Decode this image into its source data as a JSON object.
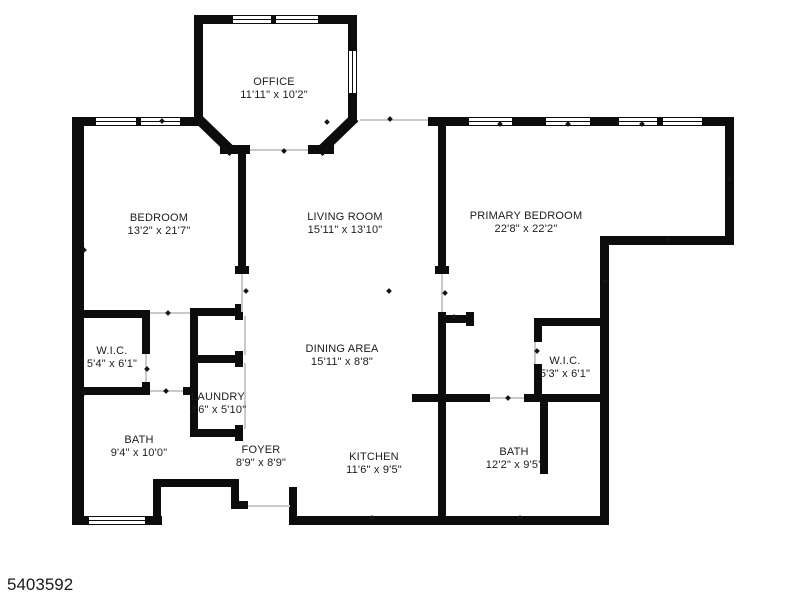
{
  "image_type": "floor-plan",
  "colors": {
    "wall": "#0c0c0c",
    "background": "#ffffff",
    "text": "#1c1c1c",
    "opening_line": "#c9c9c9"
  },
  "footer": {
    "listing_id": "5403592"
  },
  "rooms": [
    {
      "name": "OFFICE",
      "dims": "11'11\" x 10'2\""
    },
    {
      "name": "BEDROOM",
      "dims": "13'2\" x 21'7\""
    },
    {
      "name": "LIVING ROOM",
      "dims": "15'11\" x 13'10\""
    },
    {
      "name": "PRIMARY BEDROOM",
      "dims": "22'8\" x 22'2\""
    },
    {
      "name": "W.I.C.",
      "dims": "5'4\" x 6'1\""
    },
    {
      "name": "DINING AREA",
      "dims": "15'11\" x 8'8\""
    },
    {
      "name": "W.I.C.",
      "dims": "5'3\" x 6'1\""
    },
    {
      "name": "LAUNDRY",
      "dims": "3'6\" x 5'10\""
    },
    {
      "name": "BATH",
      "dims": "9'4\" x 10'0\""
    },
    {
      "name": "FOYER",
      "dims": "8'9\" x 8'9\""
    },
    {
      "name": "KITCHEN",
      "dims": "11'6\" x 9'5\""
    },
    {
      "name": "BATH",
      "dims": "12'2\" x 9'5\""
    }
  ]
}
